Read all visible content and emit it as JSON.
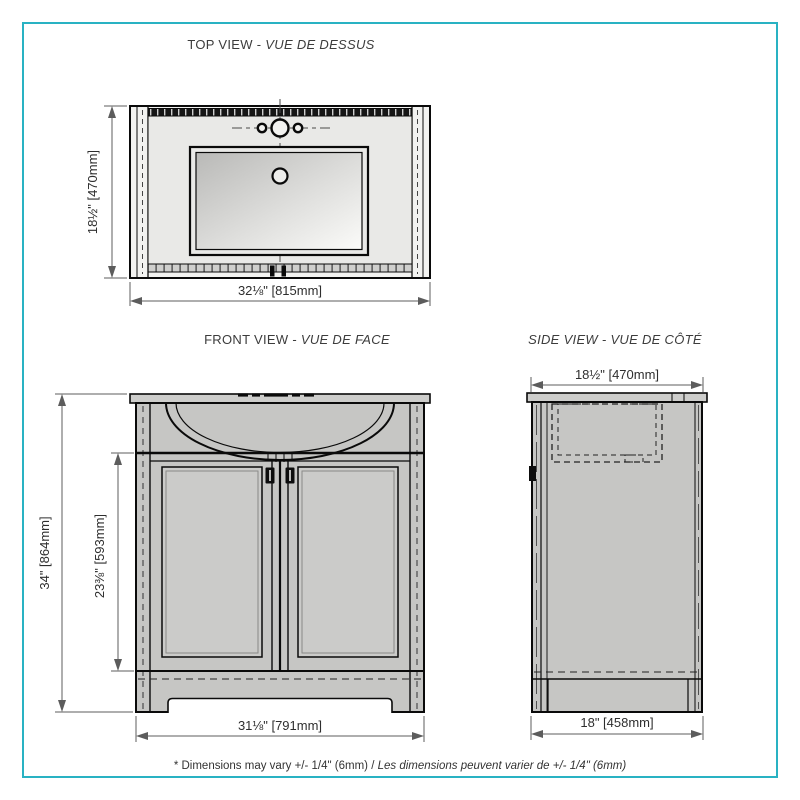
{
  "page": {
    "border_color": "#29b2c3",
    "footer_note_en": "* Dimensions may vary +/- 1/4\" (6mm) / ",
    "footer_note_fr": "Les dimensions peuvent varier de +/- 1/4\" (6mm)"
  },
  "top_view": {
    "title_en": "TOP VIEW - ",
    "title_fr": "VUE DE DESSUS",
    "depth_dim": "18½\" [470mm]",
    "width_dim": "32⅛\" [815mm]"
  },
  "front_view": {
    "title_en": "FRONT VIEW - ",
    "title_fr": "VUE DE FACE",
    "height_dim": "34\" [864mm]",
    "door_height_dim": "23⅜\" [593mm]",
    "width_dim": "31⅛\" [791mm]"
  },
  "side_view": {
    "title_it": "SIDE VIEW - VUE DE CÔTÉ",
    "top_width_dim": "18½\" [470mm]",
    "bottom_width_dim": "18\" [458mm]"
  }
}
